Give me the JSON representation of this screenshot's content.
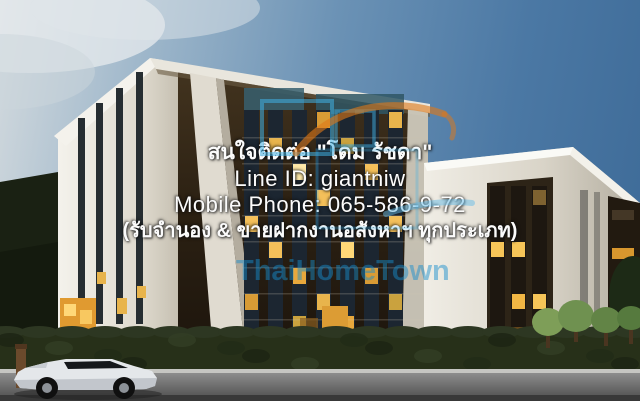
{
  "photo": {
    "subject": "Modern low-rise condominium 3D rendering at dusk with illuminated windows, hedge wall, small trees and a white car on the street"
  },
  "overlay": {
    "lines": [
      "สนใจติดต่อ \"โดม รัชดา\"",
      "Line ID: giantniw",
      "Mobile Phone: 065-586-9-72",
      "(รับจำนอง & ขายฝากงานอสังหาฯ ทุกประเภท)"
    ]
  },
  "watermark": {
    "brand": "ThaiHomeTown",
    "text_color": "#188ecc",
    "swoosh_color": "#e07818",
    "squares_color": "#3fb0e4"
  },
  "colors": {
    "sky_dark": "#3d6a97",
    "sky_light": "#d3dade",
    "facade_dark": "#322616",
    "window_lit": "#f4c05a",
    "panel_white": "#ece8df",
    "hedge_green": "#273019",
    "road_gray": "#6e6e6e",
    "car_white": "#e4e7ea"
  }
}
